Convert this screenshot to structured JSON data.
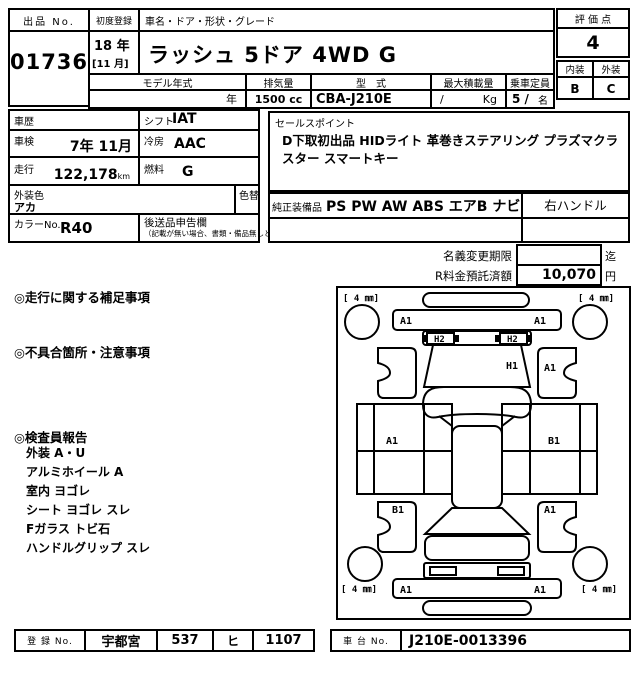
{
  "header": {
    "lot_label": "出品 No.",
    "lot_number": "01736",
    "first_reg_label": "初度登録",
    "first_reg_year": "18 年",
    "first_reg_month": "[11 月]",
    "name_label": "車名・ドア・形状・グレード",
    "name_value": "ラッシュ 5ドア 4WD G",
    "model_year_label": "モデル年式",
    "model_year_value": "年",
    "displacement_label": "排気量",
    "displacement_value": "1500 cc",
    "model_code_label": "型　式",
    "model_code_value": "CBA-J210E",
    "max_load_label": "最大積載量",
    "max_load_slash": "/",
    "max_load_unit": "Kg",
    "capacity_label": "乗車定員",
    "capacity_value": "5 /",
    "capacity_unit": "名",
    "score_label": "評 価 点",
    "score_value": "4",
    "interior_label": "内装",
    "exterior_label": "外装",
    "interior_grade": "B",
    "exterior_grade": "C"
  },
  "spec": {
    "history_label": "車歴",
    "shift_label": "シフト",
    "shift_value": "IAT",
    "inspection_label": "車検",
    "inspection_value": "7年 11月",
    "ac_label": "冷房",
    "ac_value": "AAC",
    "mileage_label": "走行",
    "mileage_value": "122,178",
    "mileage_unit": "km",
    "fuel_label": "燃料",
    "fuel_value": "G",
    "body_color_label": "外装色",
    "body_color_value": "アカ",
    "color_change_label": "色替",
    "color_no_label": "カラーNo.",
    "color_no_value": "R40",
    "later_goods_label": "後送品申告欄",
    "later_goods_note": "（記載が無い場合、書類・備品無しと致します）"
  },
  "sales": {
    "label": "セールスポイント",
    "text": "D下取初出品 HIDライト 革巻きステアリング プラズマクラスター スマートキー",
    "equipment_label": "純正装備品",
    "equipment_value": "PS PW AW ABS エアB ナビ",
    "handle_value": "右ハンドル"
  },
  "fees": {
    "name_change_label": "名義変更期限",
    "name_change_value": "",
    "name_change_suffix": "迄",
    "recycle_label": "R料金預託済額",
    "recycle_value": "10,070",
    "recycle_suffix": "円"
  },
  "notes": {
    "running_label": "◎走行に関する補足事項",
    "defects_label": "◎不具合箇所・注意事項",
    "inspector_label": "◎検査員報告",
    "inspector_items": [
      "外装 A・U",
      "アルミホイール A",
      "室内 ヨゴレ",
      "シート ヨゴレ スレ",
      "Fガラス トビ石",
      "ハンドルグリップ スレ"
    ]
  },
  "diagram": {
    "tread_front_left": "[ 4 ㎜]",
    "tread_front_right": "[ 4 ㎜]",
    "tread_rear_left": "[ 4 ㎜]",
    "tread_rear_right": "[ 4 ㎜]",
    "front_bumper_left": "A1",
    "front_bumper_right": "A1",
    "headlight_left": "H2",
    "headlight_right": "H2",
    "hood": "H1",
    "front_fender_right": "A1",
    "left_door": "A1",
    "right_door": "B1",
    "rear_fender_left": "B1",
    "rear_fender_right": "A1",
    "rear_bumper_left": "A1",
    "rear_bumper_right": "A1"
  },
  "footer": {
    "reg_label": "登 録 No.",
    "reg_area": "宇都宮",
    "reg_class": "537",
    "reg_kana": "ヒ",
    "reg_number": "1107",
    "chassis_label": "車 台 No.",
    "chassis_value": "J210E-0013396"
  }
}
